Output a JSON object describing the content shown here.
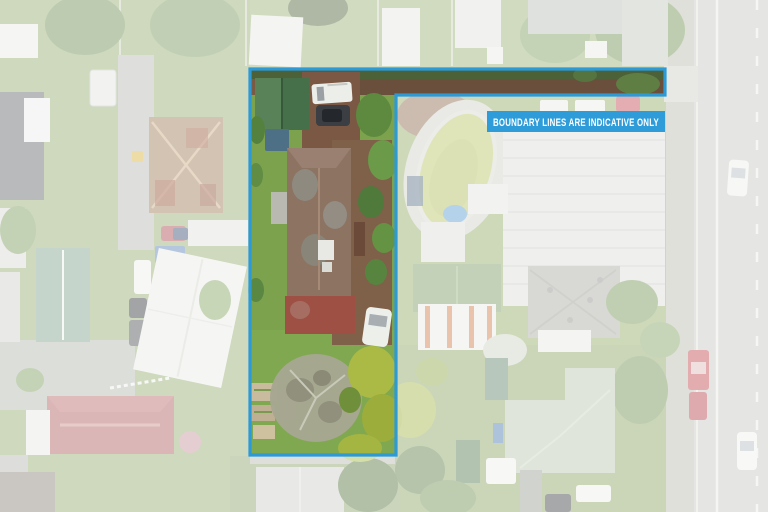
{
  "banner": {
    "text": "BOUNDARY LINES ARE INDICATIVE ONLY"
  },
  "colors": {
    "boundary": "#2b9ad6",
    "banner_bg": "#2f9cda",
    "banner_text": "#ffffff"
  }
}
